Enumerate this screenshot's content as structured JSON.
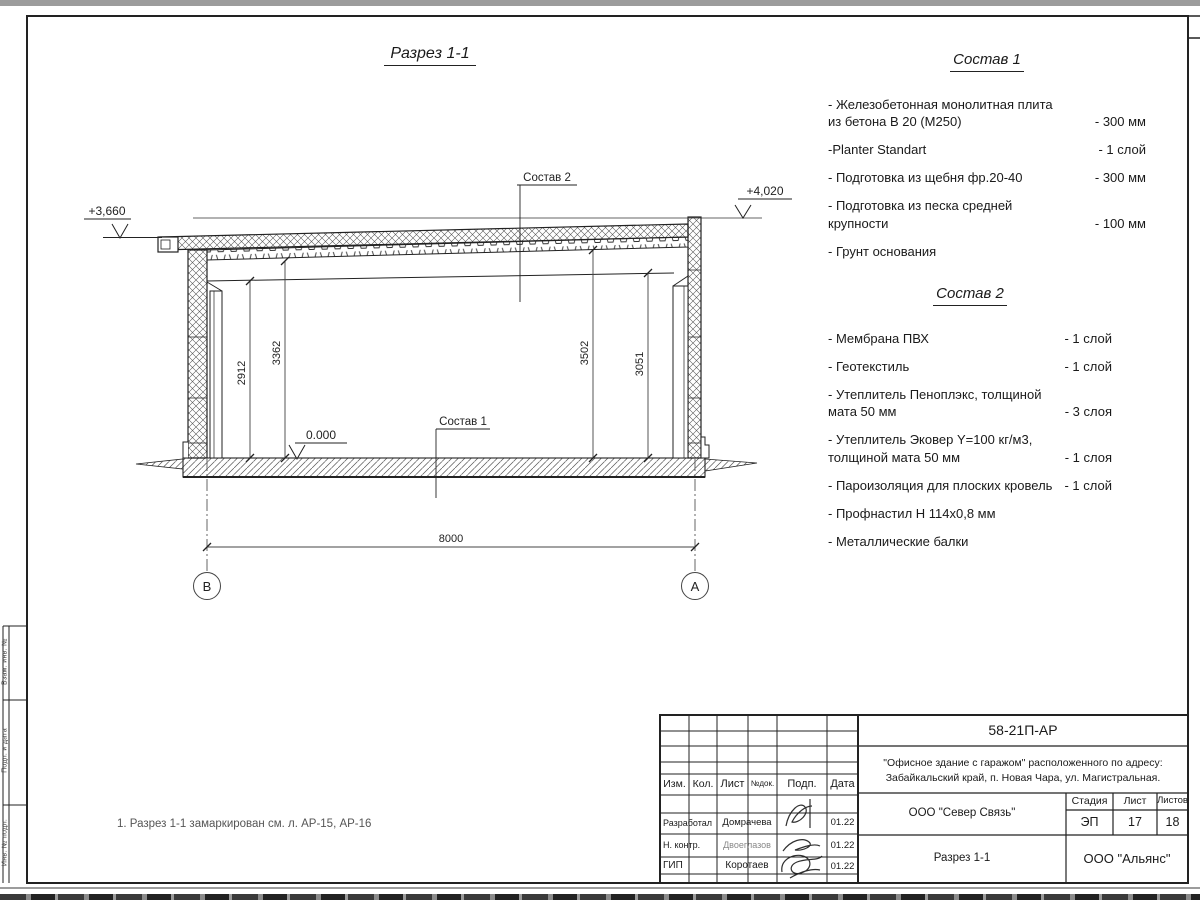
{
  "sheet": {
    "view_title": "Разрез 1-1",
    "note": "1. Разрез 1-1 замаркирован см. л. АР-15, АР-16"
  },
  "drawing": {
    "elevation_left": "+3,660",
    "elevation_right": "+4,020",
    "elevation_zero": "0.000",
    "label_sostav2": "Состав 2",
    "label_sostav1": "Состав 1",
    "dim_floor_to_beam_left": "2912",
    "dim_floor_to_roof_left": "3362",
    "dim_floor_to_roof_right": "3502",
    "dim_floor_to_beam_right": "3051",
    "dim_span": "8000",
    "axis_left": "В",
    "axis_right": "А"
  },
  "sostav1": {
    "title": "Состав 1",
    "items": [
      {
        "label": "- Железобетонная монолитная плита из бетона В 20 (М250)",
        "value": "- 300 мм"
      },
      {
        "label": "-Planter Standart",
        "value": "- 1 слой"
      },
      {
        "label": "- Подготовка из щебня фр.20-40",
        "value": "- 300 мм"
      },
      {
        "label": "- Подготовка из песка средней крупности",
        "value": "- 100 мм"
      },
      {
        "label": "- Грунт основания",
        "value": ""
      }
    ]
  },
  "sostav2": {
    "title": "Состав 2",
    "items": [
      {
        "label": "- Мембрана ПВХ",
        "value": "- 1 слой"
      },
      {
        "label": "- Геотекстиль",
        "value": "- 1 слой"
      },
      {
        "label": "- Утеплитель Пеноплэкс, толщиной мата 50 мм",
        "value": "- 3  слоя"
      },
      {
        "label": "- Утеплитель Эковер Y=100 кг/м3, толщиной мата 50 мм",
        "value": "- 1 слоя"
      },
      {
        "label": "- Пароизоляция для плоских кровель",
        "value": "- 1 слой"
      },
      {
        "label": "- Профнастил Н 114х0,8 мм",
        "value": ""
      },
      {
        "label": "- Металлические балки",
        "value": ""
      }
    ]
  },
  "titleblock": {
    "doc_number": "58-21П-АР",
    "project_line1": "\"Офисное здание с гаражом\" расположенного по адресу:",
    "project_line2": "Забайкальский край, п. Новая Чара, ул. Магистральная.",
    "col_izm": "Изм.",
    "col_kol": "Кол.",
    "col_list": "Лист",
    "col_ndok": "№док.",
    "col_podp": "Подп.",
    "col_data": "Дата",
    "row_developed_role": "Разработал",
    "row_developed_name": "Домрачева",
    "row_developed_date": "01.22",
    "row_ncontrol_role": "Н. контр.",
    "row_ncontrol_name": "Двоеглазов",
    "row_ncontrol_date": "01.22",
    "row_gip_role": "ГИП",
    "row_gip_name": "Коротаев",
    "row_gip_date": "01.22",
    "contractor": "ООО \"Север Связь\"",
    "stage_label": "Стадия",
    "sheet_label": "Лист",
    "sheets_label": "Листов",
    "stage_value": "ЭП",
    "sheet_value": "17",
    "sheets_value": "18",
    "sheet_title": "Разрез 1-1",
    "organization": "ООО \"Альянс\""
  },
  "margin": {
    "label_top": "Взам. инв. №",
    "label_mid": "Подп. и дата",
    "label_bottom": "Инв. № подл."
  }
}
